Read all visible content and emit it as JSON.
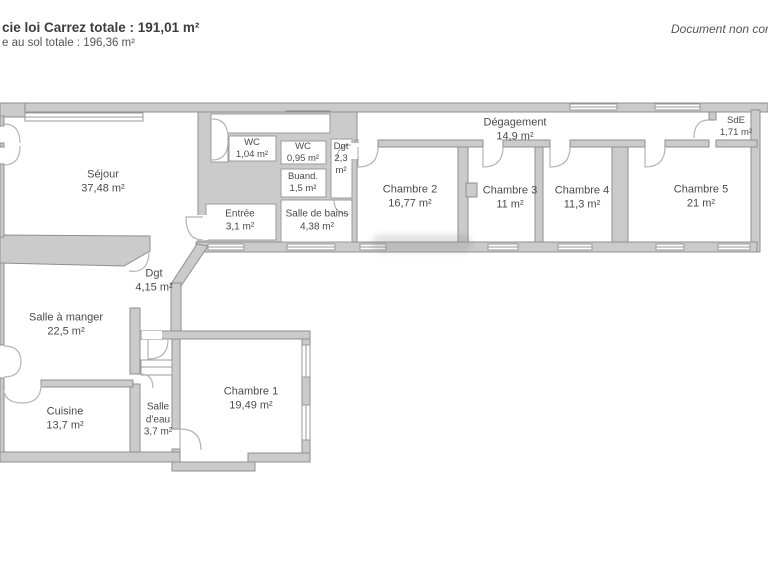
{
  "header": {
    "area_line1": "cie loi Carrez totale : 191,01 m²",
    "area_line2": "e au sol totale : 196,36 m²",
    "disclaimer": "Document non cor"
  },
  "colors": {
    "wall_fill": "#cbcbcb",
    "wall_stroke": "#8f8f8f",
    "door_arc": "#b5b5b5",
    "label_text": "#4a4a4a",
    "background": "#ffffff"
  },
  "rooms": [
    {
      "name": "Séjour",
      "area": "37,48 m²"
    },
    {
      "name": "WC",
      "area": "1,04 m²"
    },
    {
      "name": "WC",
      "area": "0,95 m²"
    },
    {
      "name": "Buand.",
      "area": "1,5 m²"
    },
    {
      "name": "Dgt",
      "area": "2,3 m²"
    },
    {
      "name": "Dégagement",
      "area": "14,9 m²"
    },
    {
      "name": "SdE",
      "area": "1,71 m²"
    },
    {
      "name": "Entrée",
      "area": "3,1 m²"
    },
    {
      "name": "Salle de bains",
      "area": "4,38 m²"
    },
    {
      "name": "Chambre 2",
      "area": "16,77 m²"
    },
    {
      "name": "Chambre 3",
      "area": "11 m²"
    },
    {
      "name": "Chambre 4",
      "area": "11,3 m²"
    },
    {
      "name": "Chambre 5",
      "area": "21 m²"
    },
    {
      "name": "Dgt",
      "area": "4,15 m²"
    },
    {
      "name": "Salle à manger",
      "area": "22,5 m²"
    },
    {
      "name": "Cuisine",
      "area": "13,7 m²"
    },
    {
      "name": "Salle d'eau",
      "area": "3,7 m²"
    },
    {
      "name": "Chambre 1",
      "area": "19,49 m²"
    }
  ]
}
